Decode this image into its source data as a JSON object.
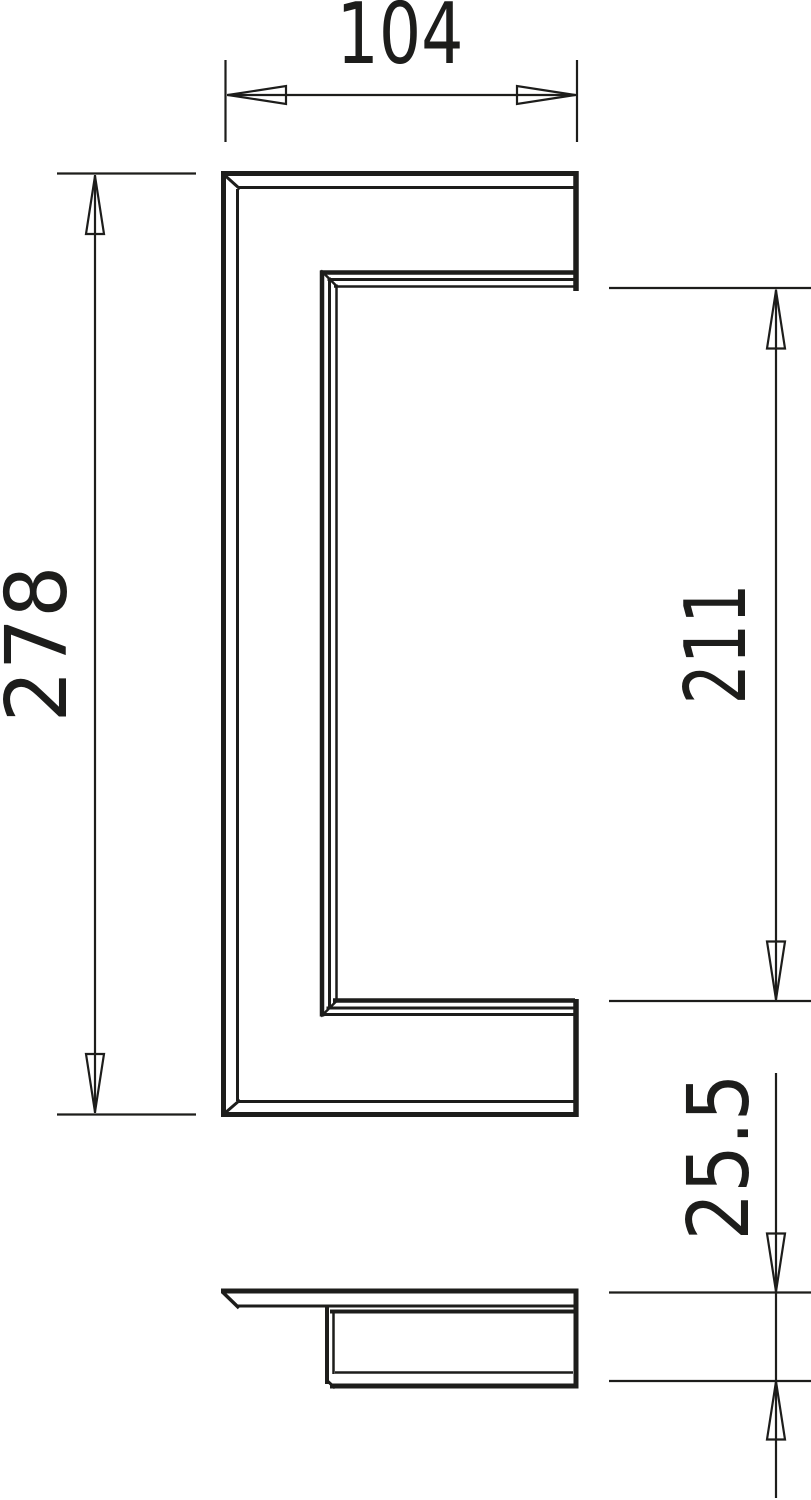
{
  "page": {
    "title": "handle-profile-technical-drawing",
    "background": "#ffffff",
    "line_color": "#1d1d1b"
  },
  "views": {
    "front": {
      "label": "front-view-c-profile"
    },
    "bottom": {
      "label": "bottom-view-profile"
    }
  },
  "dimensions": {
    "width": "104",
    "overall_height": "278",
    "opening_height": "211",
    "depth": "25.5"
  }
}
